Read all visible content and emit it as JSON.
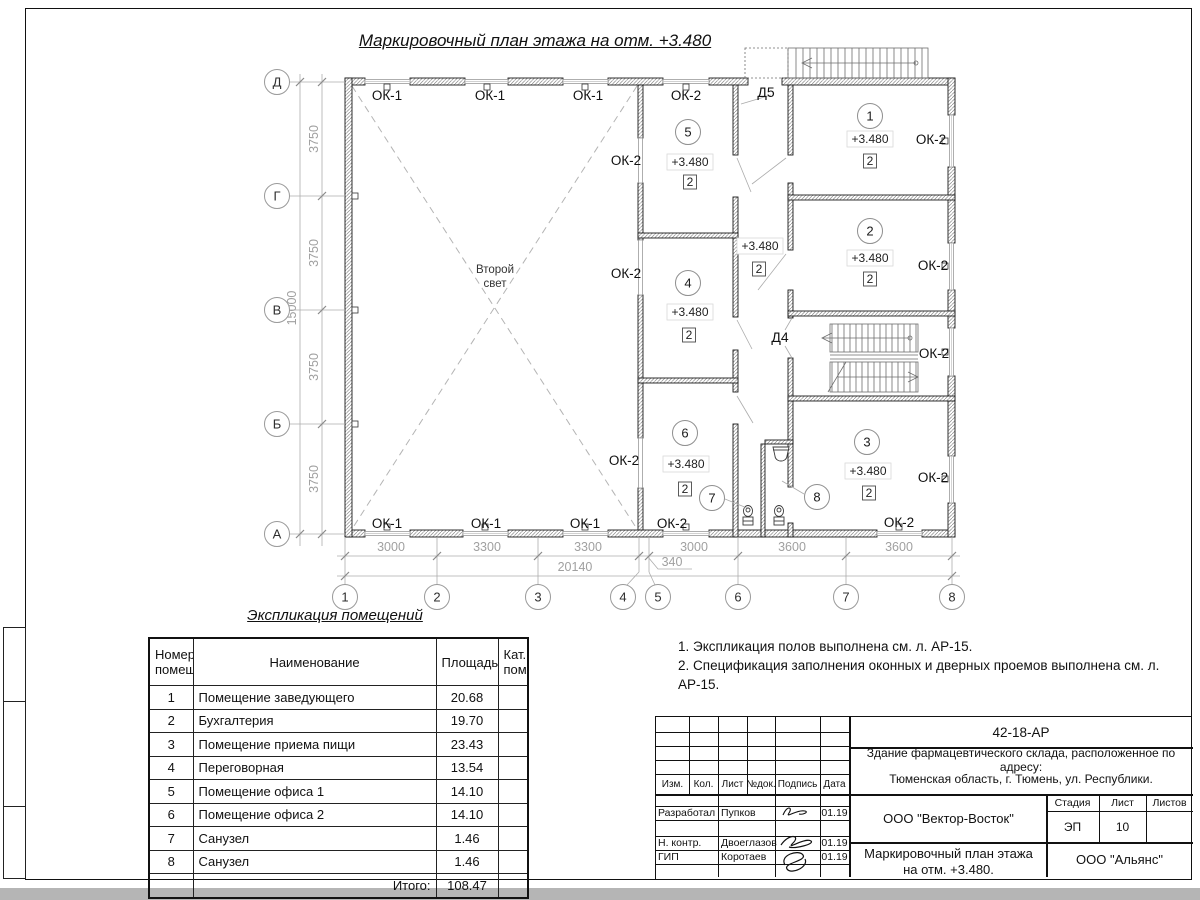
{
  "drawing_title": "Маркировочный план этажа на отм. +3.480",
  "plan": {
    "second_light_line1": "Второй",
    "second_light_line2": "свет",
    "window_type1": "ОК-1",
    "window_type2": "ОК-2",
    "door4": "Д4",
    "door5": "Д5",
    "elevation": "+3.480",
    "category": "2",
    "room_numbers": [
      "1",
      "2",
      "3",
      "4",
      "5",
      "6",
      "7",
      "8"
    ],
    "axis_cols": [
      "1",
      "2",
      "3",
      "4",
      "5",
      "6",
      "7",
      "8"
    ],
    "axis_rows": [
      "Д",
      "Г",
      "В",
      "Б",
      "А"
    ],
    "dims_bottom": [
      "3000",
      "3300",
      "3300",
      "3000",
      "3600",
      "3600"
    ],
    "dim_offset": "340",
    "dim_total_bottom": "20140",
    "dims_left": [
      "3750",
      "3750",
      "3750",
      "3750"
    ],
    "dim_total_left": "15000"
  },
  "schedule": {
    "title": "Экспликация помещений",
    "headers": [
      "Номер помещ.",
      "Наименование",
      "Площадь",
      "Кат. пом."
    ],
    "rows": [
      {
        "num": "1",
        "name": "Помещение заведующего",
        "area": "20.68",
        "cat": ""
      },
      {
        "num": "2",
        "name": "Бухгалтерия",
        "area": "19.70",
        "cat": ""
      },
      {
        "num": "3",
        "name": "Помещение приема пищи",
        "area": "23.43",
        "cat": ""
      },
      {
        "num": "4",
        "name": "Переговорная",
        "area": "13.54",
        "cat": ""
      },
      {
        "num": "5",
        "name": "Помещение офиса 1",
        "area": "14.10",
        "cat": ""
      },
      {
        "num": "6",
        "name": "Помещение офиса 2",
        "area": "14.10",
        "cat": ""
      },
      {
        "num": "7",
        "name": "Санузел",
        "area": "1.46",
        "cat": ""
      },
      {
        "num": "8",
        "name": "Санузел",
        "area": "1.46",
        "cat": ""
      }
    ],
    "total_label": "Итого:",
    "total_value": "108.47"
  },
  "notes": {
    "line1": "1. Экспликация полов выполнена см. л. АР-15.",
    "line2": "2. Спецификация заполнения оконных и дверных проемов выполнена см. л. АР-15."
  },
  "titleblock": {
    "doc_number": "42-18-АР",
    "object_line1": "Здание фармацевтического склада, расположенное по адресу:",
    "object_line2": "Тюменская область, г. Тюмень, ул. Республики.",
    "col_headers": [
      "Изм.",
      "Кол.",
      "Лист",
      "№док.",
      "Подпись",
      "Дата"
    ],
    "sign_rows": [
      {
        "role": "Разработал",
        "name": "Пупков",
        "date": "01.19"
      },
      {
        "role": "Н. контр.",
        "name": "Двоеглазов",
        "date": "01.19"
      },
      {
        "role": "ГИП",
        "name": "Коротаев",
        "date": "01.19"
      }
    ],
    "company": "ООО \"Вектор-Восток\"",
    "stage_label": "Стадия",
    "sheet_label": "Лист",
    "sheets_label": "Листов",
    "stage": "ЭП",
    "sheet_num": "10",
    "drawing_name_line1": "Маркировочный план этажа",
    "drawing_name_line2": "на отм. +3.480.",
    "org": "ООО \"Альянс\""
  }
}
